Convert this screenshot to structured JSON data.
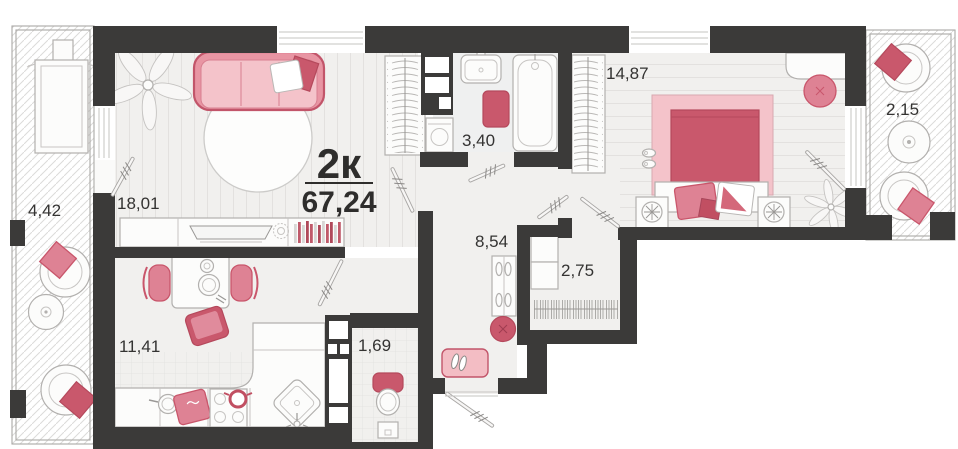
{
  "plan": {
    "type_label": "2к",
    "total_area": "67,24",
    "rooms": [
      {
        "name": "loggia-left",
        "area": "4,42"
      },
      {
        "name": "living-room",
        "area": "18,01"
      },
      {
        "name": "bathroom",
        "area": "3,40"
      },
      {
        "name": "bedroom",
        "area": "14,87"
      },
      {
        "name": "loggia-right",
        "area": "2,15"
      },
      {
        "name": "kitchen",
        "area": "11,41"
      },
      {
        "name": "wc",
        "area": "1,69"
      },
      {
        "name": "hallway",
        "area": "8,54"
      },
      {
        "name": "closet",
        "area": "2,75"
      }
    ],
    "colors": {
      "wall": "#3b3a39",
      "floor": "#f1f0ee",
      "accent": "#c9586c",
      "accent_mid": "#de8294",
      "accent_light": "#f3bdc4",
      "text": "#343332"
    }
  }
}
